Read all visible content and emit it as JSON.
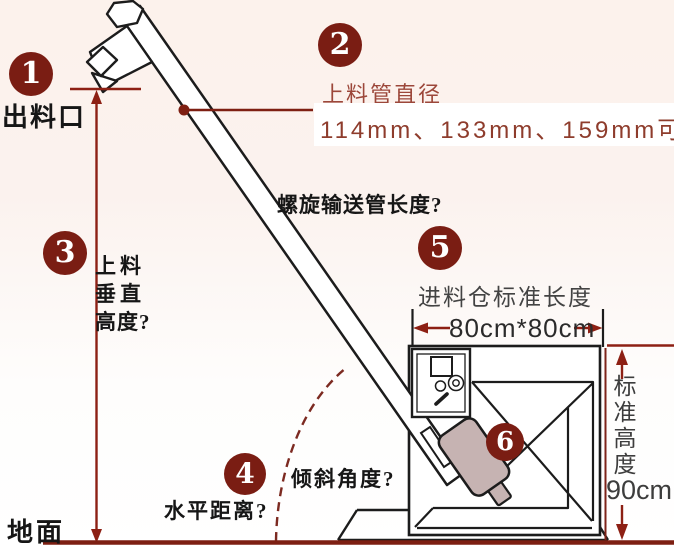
{
  "callouts": {
    "c1": {
      "number": "1",
      "label": "出料口"
    },
    "c2": {
      "number": "2",
      "label": "上料管直径",
      "value": "114mm、133mm、159mm可"
    },
    "c3": {
      "number": "3",
      "label_line1": "上料",
      "label_line2": "垂直",
      "label_line3": "高度?"
    },
    "c4": {
      "number": "4",
      "label_horizontal": "水平距离?",
      "label_angle": "倾斜角度?"
    },
    "c5": {
      "number": "5",
      "label": "进料仓标准长度",
      "value": "80cm*80cm"
    },
    "c6": {
      "number": "6"
    }
  },
  "labels": {
    "pipe_length_question": "螺旋输送管长度?",
    "ground": "地面",
    "standard_height": "标准高度",
    "standard_height_value": "90cm"
  },
  "colors": {
    "badge_maroon": "#7a1d13",
    "dimension_red": "#8d2014",
    "ground_line": "#7d1f12",
    "accent_text": "#9c473a",
    "value_text": "#8e3c2c",
    "motor_fill": "#c6b3b2",
    "drawing_line": "#1c1c1c",
    "background_top": "#fcf2ec"
  }
}
